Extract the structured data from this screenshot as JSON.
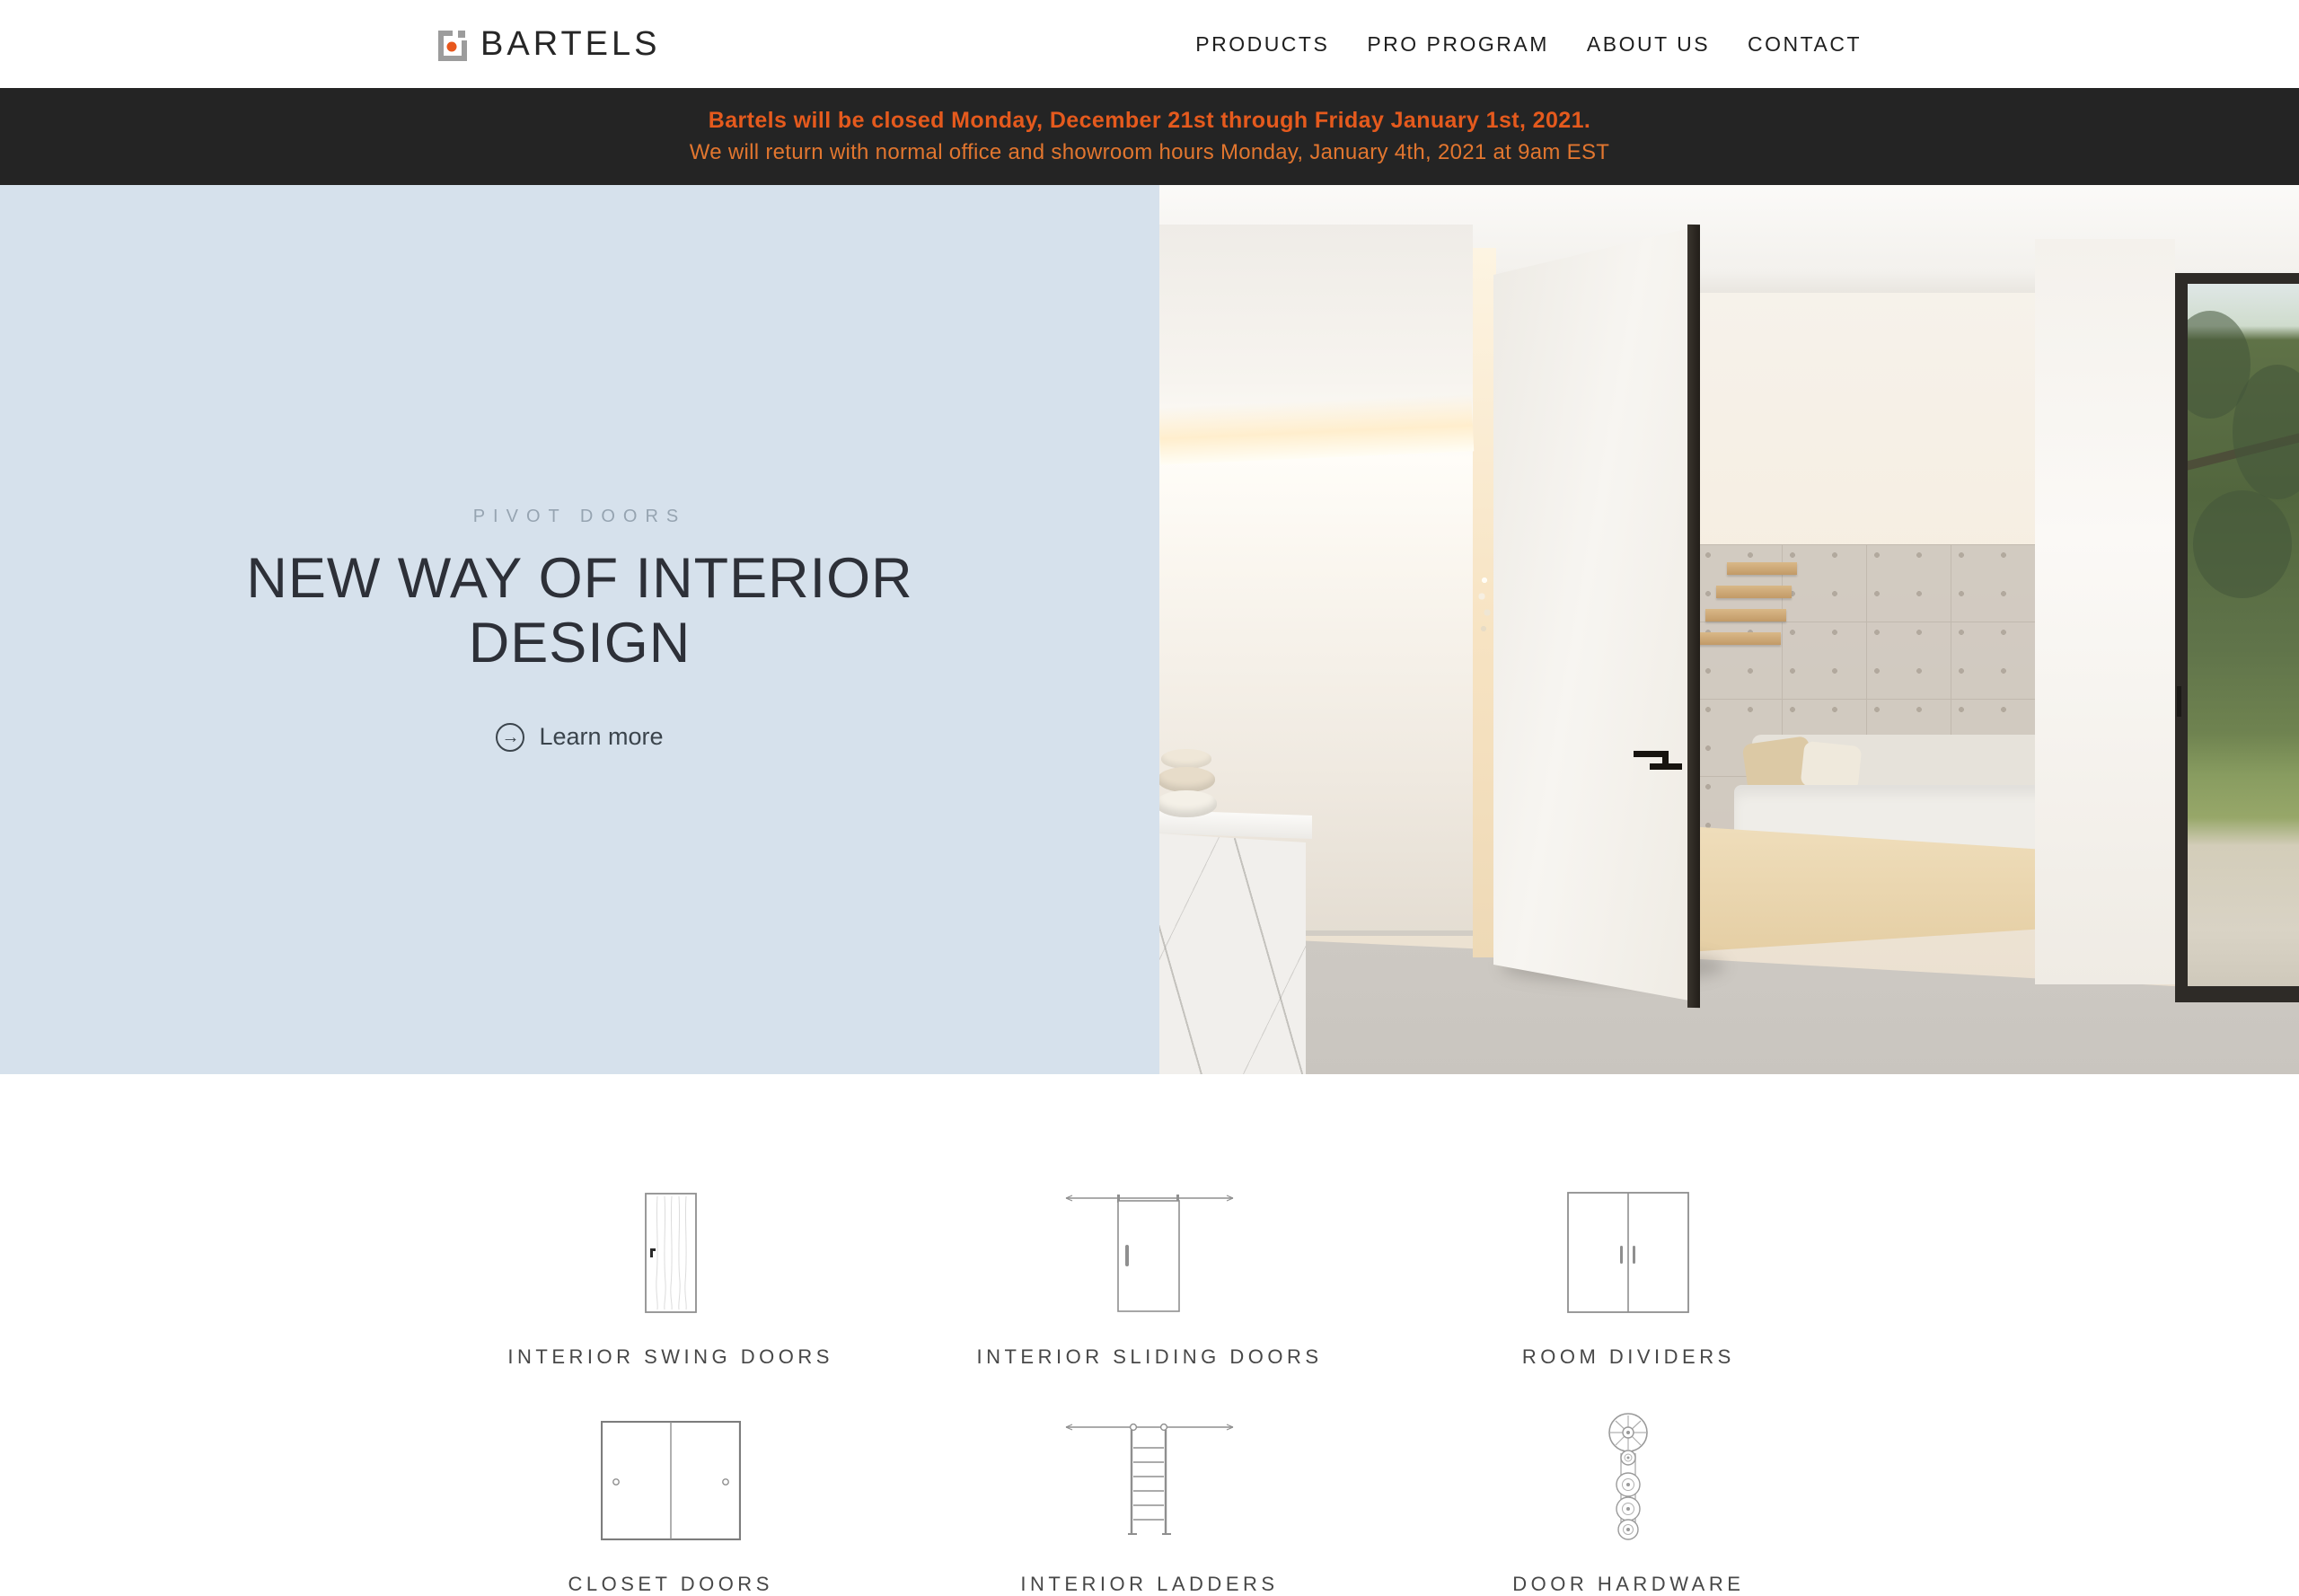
{
  "brand": {
    "name": "BARTELS"
  },
  "nav": {
    "items": [
      "PRODUCTS",
      "PRO PROGRAM",
      "ABOUT US",
      "CONTACT"
    ]
  },
  "banner": {
    "line1": "Bartels will be closed Monday, December 21st through Friday January 1st, 2021.",
    "line2": "We will return with normal office and showroom hours Monday, January 4th, 2021 at 9am EST",
    "bg_color": "#242424",
    "accent_color": "#e55a1d"
  },
  "hero": {
    "eyebrow": "PIVOT DOORS",
    "title_lines": [
      "NEW WAY OF INTERIOR",
      "DESIGN"
    ],
    "cta_label": "Learn more",
    "cta_arrow": "→",
    "panel_color": "#d6e1ec"
  },
  "categories": [
    {
      "label": "INTERIOR SWING DOORS",
      "icon": "swing-door-icon"
    },
    {
      "label": "INTERIOR SLIDING DOORS",
      "icon": "sliding-door-icon"
    },
    {
      "label": "ROOM DIVIDERS",
      "icon": "room-divider-icon"
    },
    {
      "label": "CLOSET DOORS",
      "icon": "closet-door-icon"
    },
    {
      "label": "INTERIOR LADDERS",
      "icon": "ladder-icon"
    },
    {
      "label": "DOOR HARDWARE",
      "icon": "door-hardware-icon"
    }
  ]
}
